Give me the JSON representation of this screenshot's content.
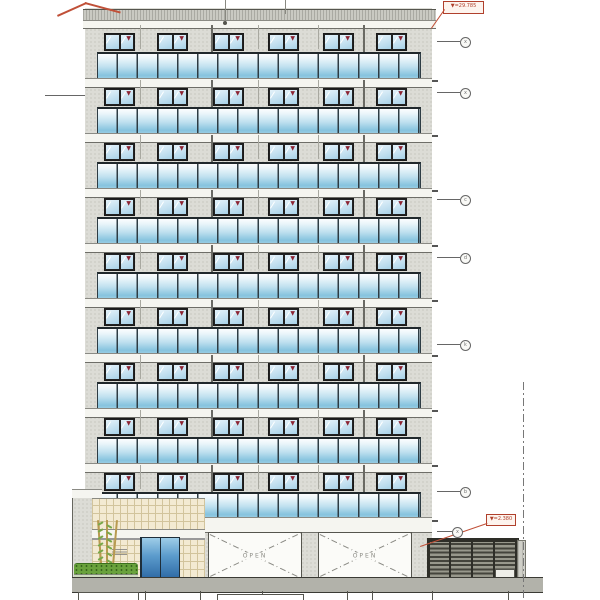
{
  "drawing": {
    "type": "building-elevation",
    "labels": {
      "top_level": "▼=29.785",
      "bottom_level": "▼=2.380",
      "open": "OPEN"
    },
    "building": {
      "upper_floor_count": 9,
      "window_pairs_per_floor": 6,
      "balcony_panels_per_floor": 16,
      "garage_openings": 2
    },
    "markers": [
      {
        "y": 37,
        "glyph": "x"
      },
      {
        "y": 88,
        "glyph": "x"
      },
      {
        "y": 195,
        "glyph": "c"
      },
      {
        "y": 253,
        "glyph": "d"
      },
      {
        "y": 340,
        "glyph": "k"
      },
      {
        "y": 487,
        "glyph": "b"
      },
      {
        "y": 527,
        "glyph": "x",
        "x": 452
      }
    ],
    "colors": {
      "facade_gray": "#dcdcd6",
      "balcony_glass_blue": "#86c3de",
      "window_glass_blue": "#bcdcee",
      "annotation_red": "#b0402c",
      "window_mark_red": "#8c2433",
      "entrance_tile_beige": "#f3ead2",
      "foliage_green": "#69a23c",
      "fence_dark": "#44443c",
      "ground_gray": "#b2b2aa"
    }
  }
}
